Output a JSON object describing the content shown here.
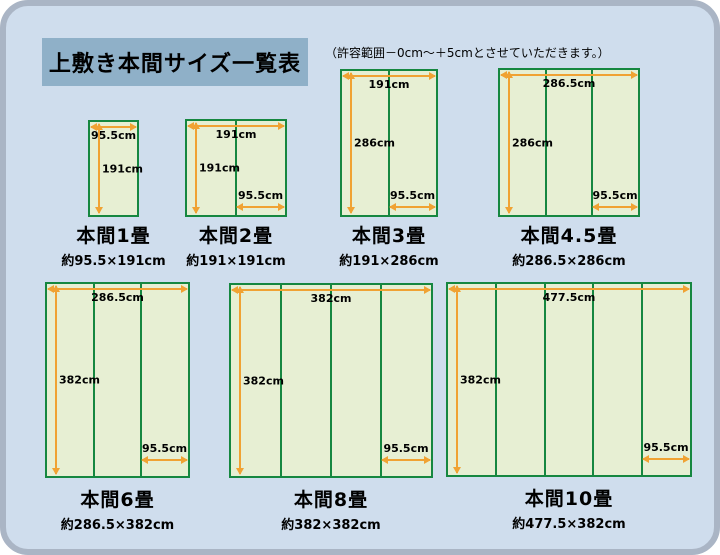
{
  "title": "上敷き本間サイズ一覧表",
  "note": "（許容範囲－0cm～＋5cmとさせていただきます。）",
  "unit": "cm",
  "colors": {
    "background": "#cfdded",
    "frame_border": "#aab5c5",
    "title_box": "#8fb0c8",
    "mat_fill": "#e7efd3",
    "mat_border": "#168740",
    "arrow": "#f0a233"
  },
  "diagrams": [
    {
      "name": "本間1畳",
      "size_label": "約95.5×191cm",
      "width_cm": 95.5,
      "height_cm": 191,
      "panels": 1,
      "width_label": "95.5cm",
      "height_label": "191cm",
      "panel_label": null
    },
    {
      "name": "本間2畳",
      "size_label": "約191×191cm",
      "width_cm": 191,
      "height_cm": 191,
      "panels": 2,
      "width_label": "191cm",
      "height_label": "191cm",
      "panel_label": "95.5cm"
    },
    {
      "name": "本間3畳",
      "size_label": "約191×286cm",
      "width_cm": 191,
      "height_cm": 286,
      "panels": 2,
      "width_label": "191cm",
      "height_label": "286cm",
      "panel_label": "95.5cm"
    },
    {
      "name": "本間4.5畳",
      "size_label": "約286.5×286cm",
      "width_cm": 286.5,
      "height_cm": 286,
      "panels": 3,
      "width_label": "286.5cm",
      "height_label": "286cm",
      "panel_label": "95.5cm"
    },
    {
      "name": "本間6畳",
      "size_label": "約286.5×382cm",
      "width_cm": 286.5,
      "height_cm": 382,
      "panels": 3,
      "width_label": "286.5cm",
      "height_label": "382cm",
      "panel_label": "95.5cm"
    },
    {
      "name": "本間8畳",
      "size_label": "約382×382cm",
      "width_cm": 382,
      "height_cm": 382,
      "panels": 4,
      "width_label": "382cm",
      "height_label": "382cm",
      "panel_label": "95.5cm"
    },
    {
      "name": "本間10畳",
      "size_label": "約477.5×382cm",
      "width_cm": 477.5,
      "height_cm": 382,
      "panels": 5,
      "width_label": "477.5cm",
      "height_label": "382cm",
      "panel_label": "95.5cm"
    }
  ]
}
